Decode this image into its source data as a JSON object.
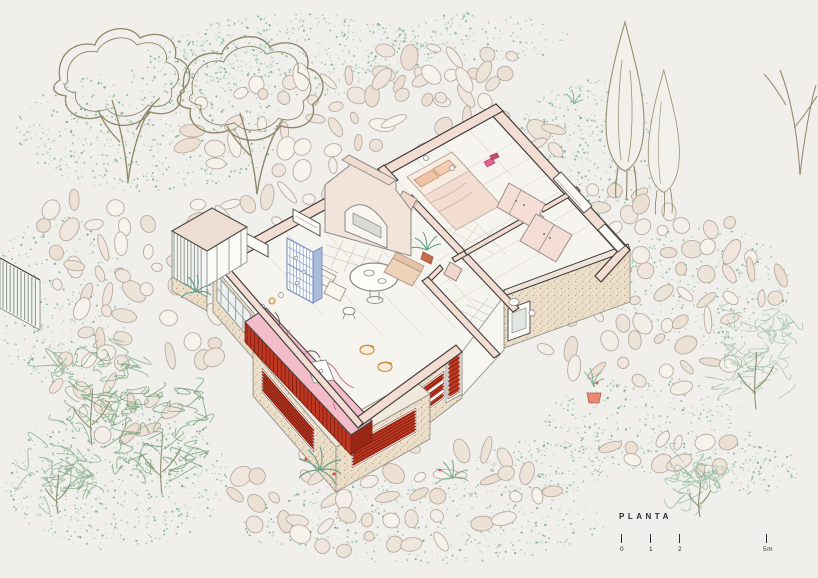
{
  "title": {
    "label": "PLANTA"
  },
  "scale_bar": {
    "ticks": [
      {
        "label": "0",
        "offset": 0
      },
      {
        "label": "1",
        "offset": 29
      },
      {
        "label": "2",
        "offset": 58
      },
      {
        "label": "5m",
        "offset": 145
      }
    ]
  },
  "palette": {
    "background": "#f0efec",
    "wall_section_fill": "#f3dcd2",
    "wall_outline": "#3f3e3c",
    "stone_wall_fill": "#ebdfca",
    "stone_stipple": "#bd9c78",
    "louver_red": "#c13a22",
    "louver_red_dark": "#7e2010",
    "marble_pink": "#f3bcc9",
    "marble_vein": "#c06a85",
    "tile_blue": "#7d97c7",
    "furniture_peach": "#eec3a6",
    "accent_magenta": "#e2638b",
    "foliage_green": "#8fbb9b",
    "tree_outline": "#8f8768",
    "cobble_outline": "#b7aca0",
    "floor_fill": "#f6f4ee",
    "text_color": "#2e2e2e"
  }
}
